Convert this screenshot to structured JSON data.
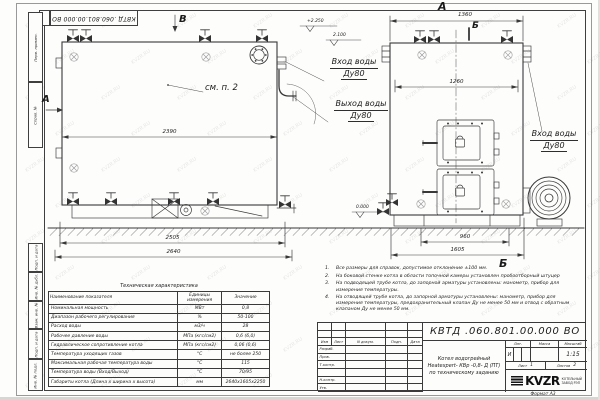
{
  "sheet": {
    "corner_stamp": "КВТД .060.801.00.000 ВО",
    "format_label": "Формат    А3",
    "watermark": "KVZR.RU",
    "side_labels_top": [
      "Перв. примен.",
      "Справ. №"
    ],
    "side_labels_bottom": [
      "Подп. и дата",
      "Инв. № дубл.",
      "Взам. инв. №",
      "Подп. и дата",
      "Инв. № подл."
    ]
  },
  "views": {
    "side": {
      "arrow_a": "А",
      "arrow_v": "В",
      "callout": "см. п. 2",
      "dim_width": "2390",
      "dim_base": "2505",
      "dim_overall": "2640",
      "inlet_line1": "Вход воды",
      "inlet_line2": "Ду80",
      "outlet_line1": "Выход воды",
      "outlet_line2": "Ду80"
    },
    "front": {
      "view_label": "А",
      "dim_top": "1360",
      "dim_inner": "1260",
      "section_label": "Б",
      "view_label_bottom": "Б",
      "dim_base": "960",
      "dim_overall": "1605",
      "inlet_line1": "Вход воды",
      "inlet_line2": "Ду80"
    },
    "elevations": {
      "top": "+2.250",
      "mid": "2.100",
      "zero": "0.000"
    }
  },
  "tech_table": {
    "title": "Техническая характеристика",
    "headers": [
      "Наименование показателя",
      "Единицы измерения",
      "Значение"
    ],
    "rows": [
      [
        "Номинальная мощность",
        "МВт",
        "0,8"
      ],
      [
        "Диапазон рабочего регулирования",
        "%",
        "50-100"
      ],
      [
        "Расход воды",
        "м3/ч",
        "28"
      ],
      [
        "Рабочее давление воды",
        "МПа (кгс/см2)",
        "0,6 (6,0)"
      ],
      [
        "Гидравлическое сопротивление котла",
        "МПа (кгс/см2)",
        "0,06 (0,6)"
      ],
      [
        "Температура уходящих газов",
        "°С",
        "не более 250"
      ],
      [
        "Максимальная рабочая температура воды",
        "°С",
        "115"
      ],
      [
        "Температура воды (Вход/Выход)",
        "°С",
        "70/95"
      ],
      [
        "Габариты котла (Длина х ширина х высота)",
        "мм",
        "2640х1605х2250"
      ]
    ]
  },
  "notes": {
    "items": [
      "Все размеры для справок, допустимое отклонение ±100 мм.",
      "На боковой стенке котла в области топочной камеры установлен пробоотборный штуцер",
      "На подводящей трубе котла, до запорной арматуры установлены: манометр, прибор для измерения температуры.",
      "На отводящей трубе котла, до запорной арматуры установлены: манометр, прибор для измерения температуры, предохранительный клапан Ду не менее 50 мм и отвод с обратным клапаном Ду не менее 50 мм."
    ]
  },
  "title_block": {
    "number": "КВТД .060.801.00.000  ВО",
    "product_line1": "Котел водогрейный",
    "product_line2": "Heatexpert- КВр -0,8- Д (ПТ)",
    "product_line3": "по техническому заданию",
    "header_cells": [
      "Изм",
      "Лист",
      "N докум.",
      "Подп.",
      "Дата"
    ],
    "rows_left": [
      "Разраб.",
      "Пров.",
      "Т.контр.",
      "Н.контр.",
      "Утв."
    ],
    "lit_label": "Лит.",
    "lit_value": "И",
    "mass_label": "Масса",
    "scale_label": "Масштаб",
    "scale_value": "1:15",
    "sheet_label": "Лист",
    "sheet_value": "1",
    "sheets_label": "Листов",
    "sheets_value": "2",
    "logo_text": "KVZR",
    "logo_sub1": "КОТЕЛЬНЫЙ",
    "logo_sub2": "ЗАВОД РЭП"
  }
}
